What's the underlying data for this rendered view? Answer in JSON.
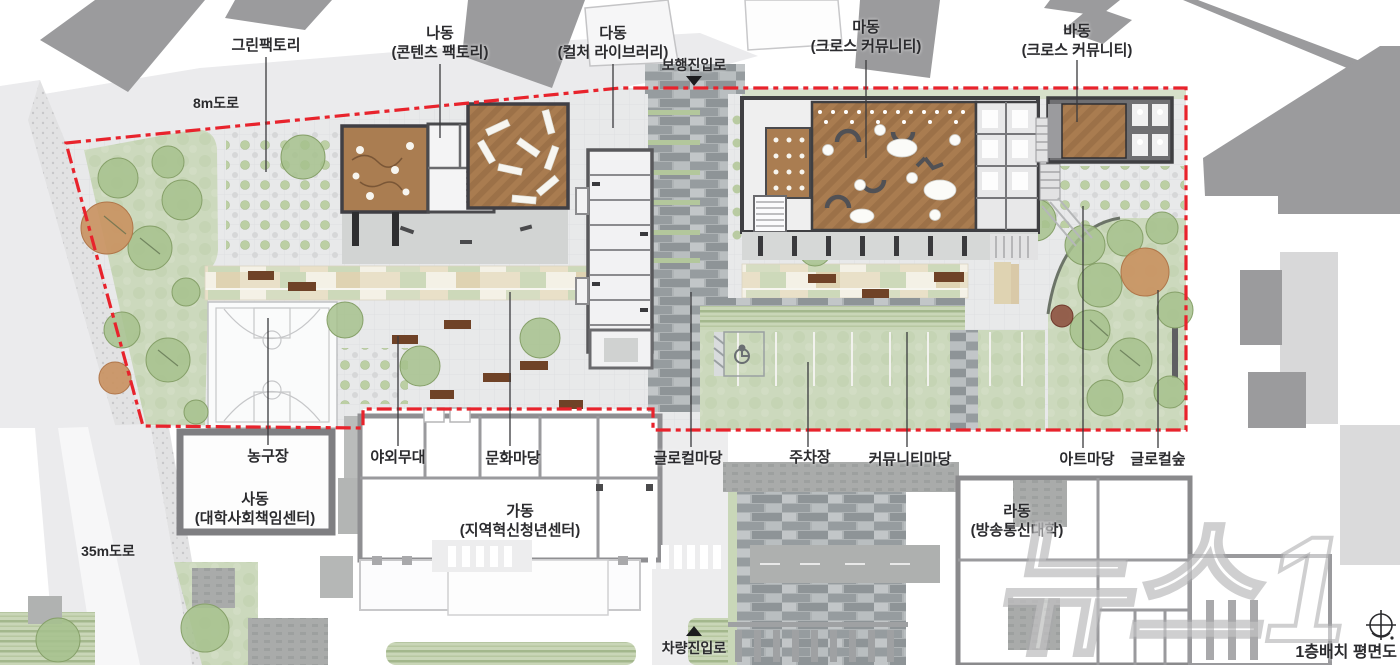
{
  "title": "1층배치 평면도",
  "watermark": "뉴스1",
  "roads": {
    "top": "8m도로",
    "left": "35m도로"
  },
  "entries": {
    "pedestrian": "보행진입로",
    "vehicle": "차량진입로"
  },
  "context": {
    "green_factory": "그린팩토리"
  },
  "buildings": {
    "na": {
      "name": "나동",
      "desc": "(콘텐츠 팩토리)"
    },
    "da": {
      "name": "다동",
      "desc": "(컬처 라이브러리)"
    },
    "ma": {
      "name": "마동",
      "desc": "(크로스 커뮤니티)"
    },
    "ba": {
      "name": "바동",
      "desc": "(크로스 커뮤니티)"
    },
    "sa": {
      "name": "사동",
      "desc": "(대학사회책임센터)"
    },
    "ga": {
      "name": "가동",
      "desc": "(지역혁신청년센터)"
    },
    "ra": {
      "name": "라동",
      "desc": "(방송통신대학)"
    }
  },
  "areas": {
    "basketball": "농구장",
    "outdoor_stage": "야외무대",
    "culture_yard": "문화마당",
    "glocal_yard": "글로컬마당",
    "parking": "주차장",
    "community_yard": "커뮤니티마당",
    "art_yard": "아트마당",
    "glocal_forest": "글로컬숲"
  },
  "colors": {
    "site_boundary": "#e8232c",
    "wood_floor": "#9c7148",
    "grass": "#ccd9bd",
    "stone": "#989ea1",
    "context_building": "#9b9b9d",
    "label_text": "#2b2b2e"
  }
}
